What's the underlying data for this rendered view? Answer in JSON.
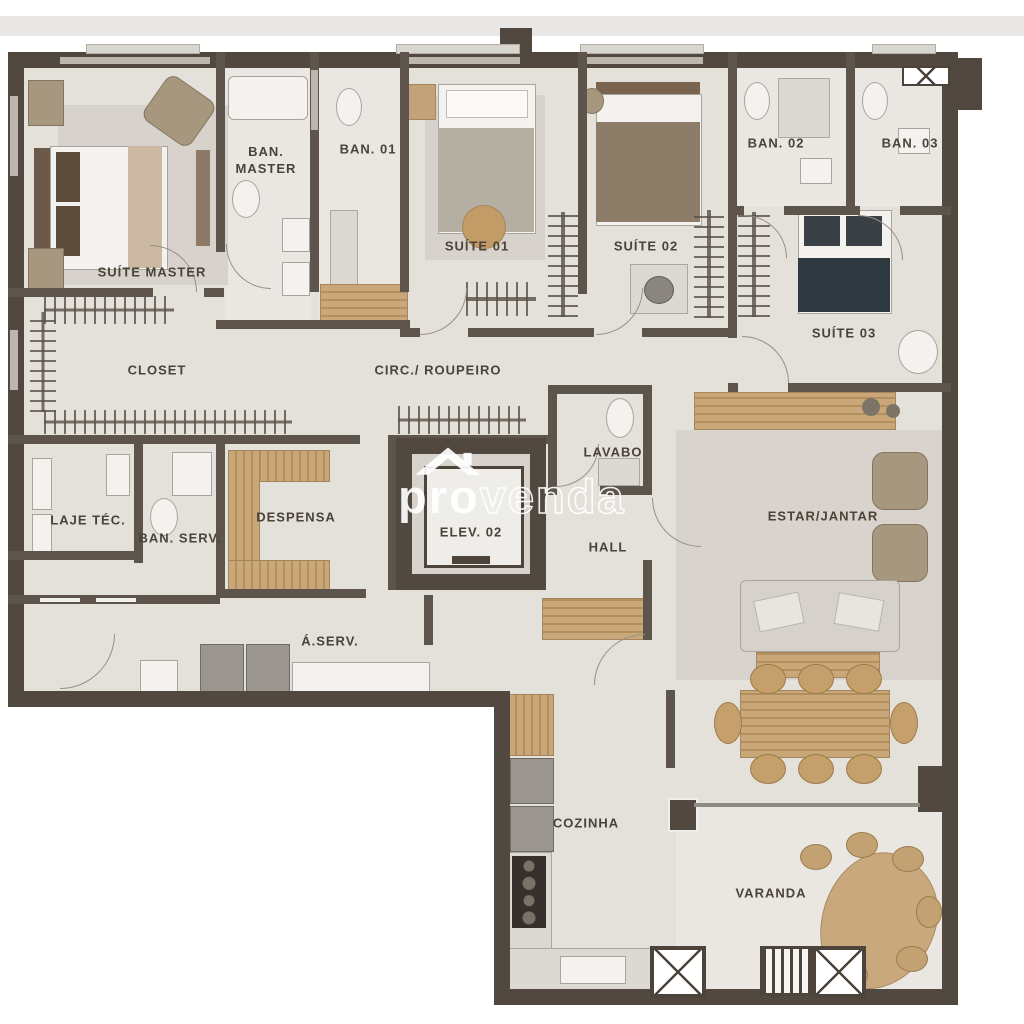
{
  "meta": {
    "type": "apartment floor plan"
  },
  "watermark": {
    "icon": "house-icon",
    "prefix": "pro",
    "suffix": "venda"
  },
  "rooms": {
    "suite_master": {
      "label": "SUÍTE MASTER"
    },
    "ban_master": {
      "label": "BAN. MASTER"
    },
    "ban_01": {
      "label": "BAN. 01"
    },
    "suite_01": {
      "label": "SUÍTE 01"
    },
    "suite_02": {
      "label": "SUÍTE 02"
    },
    "ban_02": {
      "label": "BAN. 02"
    },
    "ban_03": {
      "label": "BAN. 03"
    },
    "suite_03": {
      "label": "SUÍTE 03"
    },
    "closet": {
      "label": "CLOSET"
    },
    "circ_roupeiro": {
      "label": "CIRC./ ROUPEIRO"
    },
    "lavabo": {
      "label": "LAVABO"
    },
    "laje_tec": {
      "label": "LAJE TÉC."
    },
    "ban_serv": {
      "label": "BAN. SERV."
    },
    "despensa": {
      "label": "DESPENSA"
    },
    "elev_02": {
      "label": "ELEV. 02"
    },
    "hall": {
      "label": "HALL"
    },
    "estar_jantar": {
      "label": "ESTAR/JANTAR"
    },
    "a_serv": {
      "label": "Á.SERV."
    },
    "cozinha": {
      "label": "COZINHA"
    },
    "varanda": {
      "label": "VARANDA"
    }
  },
  "colors": {
    "wall": "#51483f",
    "floor": "#e4e0da",
    "wood": "#c2a279",
    "dark_bed": "#2e3a40",
    "label_text": "#4a4339",
    "top_band": "#e9e8e6",
    "watermark": "#ffffff"
  }
}
